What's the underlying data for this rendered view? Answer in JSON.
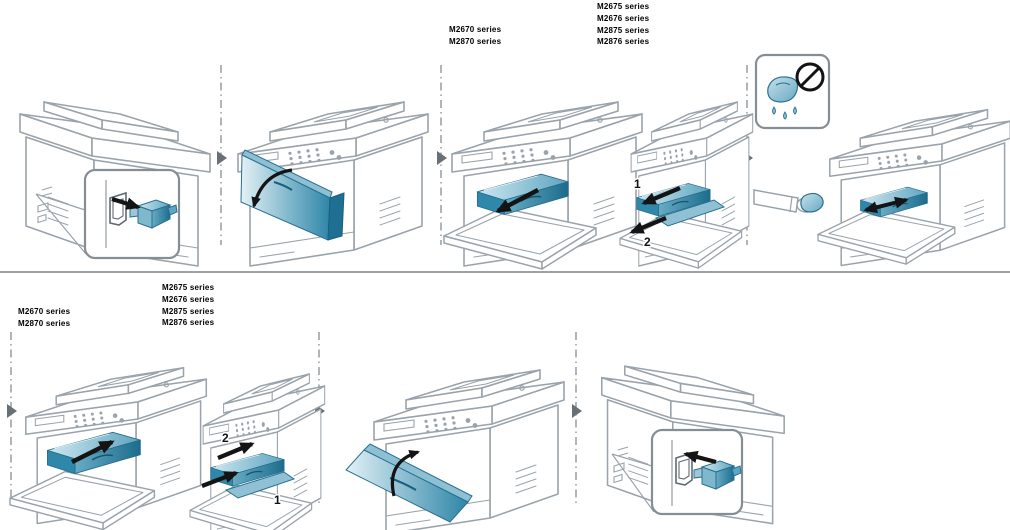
{
  "page": {
    "background": "#ffffff",
    "width": 1010,
    "height": 530
  },
  "colors": {
    "line_art": "#9aa3ab",
    "highlight_teal_dark": "#2e86a8",
    "highlight_teal_light": "#dceef4",
    "arrow_black": "#141414",
    "separator_gray": "#8f969c",
    "divider_gray": "#9aa1a7"
  },
  "labels": {
    "top_left_models": [
      "M2670 series",
      "M2870 series"
    ],
    "top_right_models": [
      "M2675 series",
      "M2676 series",
      "M2875 series",
      "M2876 series"
    ],
    "bottom_left_models": [
      "M2670 series",
      "M2870 series"
    ],
    "bottom_right_models": [
      "M2675 series",
      "M2676 series",
      "M2875 series",
      "M2876 series"
    ]
  },
  "step_numbers": {
    "top_shake_remove": [
      "1",
      "2"
    ],
    "bottom_insert": [
      "2",
      "1"
    ]
  },
  "icons": {
    "top_row_steps": [
      "unplug-power-cord-illustration",
      "open-front-cover-illustration",
      "pull-out-toner-cartridge-illustration",
      "shake-and-pull-out-cartridge-illustration",
      "wipe-inside-printer-illustration"
    ],
    "bottom_row_steps": [
      "insert-toner-cartridge-illustration",
      "insert-cartridge-two-steps-illustration",
      "close-front-cover-illustration",
      "plug-in-power-cord-illustration"
    ],
    "prohibition_icon": "no-wet-cloth-prohibition-icon",
    "flow_arrow_icon": "step-flow-arrow-icon"
  }
}
